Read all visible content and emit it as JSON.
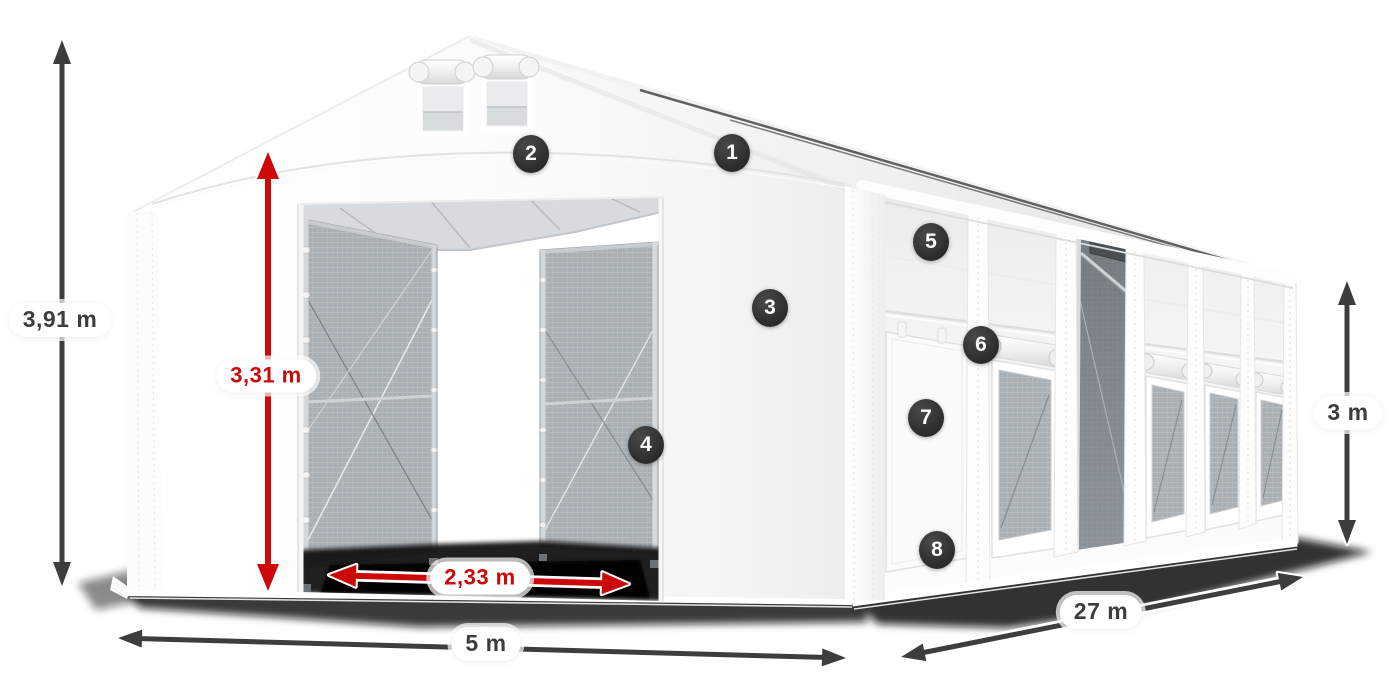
{
  "diagram": {
    "dimensions": {
      "total_height": {
        "label": "3,91 m",
        "style": "dark"
      },
      "door_height": {
        "label": "3,31 m",
        "style": "red"
      },
      "door_width": {
        "label": "2,33 m",
        "style": "red"
      },
      "front_width": {
        "label": "5 m",
        "style": "dark"
      },
      "side_length": {
        "label": "27 m",
        "style": "dark"
      },
      "side_height": {
        "label": "3 m",
        "style": "dark"
      }
    },
    "feature_markers": [
      "1",
      "2",
      "3",
      "4",
      "5",
      "6",
      "7",
      "8"
    ],
    "colors": {
      "dimension_dark": "#3d3d3d",
      "dimension_red": "#cc0808",
      "marker_background": "#2b2b2b",
      "marker_text": "#ffffff"
    }
  }
}
